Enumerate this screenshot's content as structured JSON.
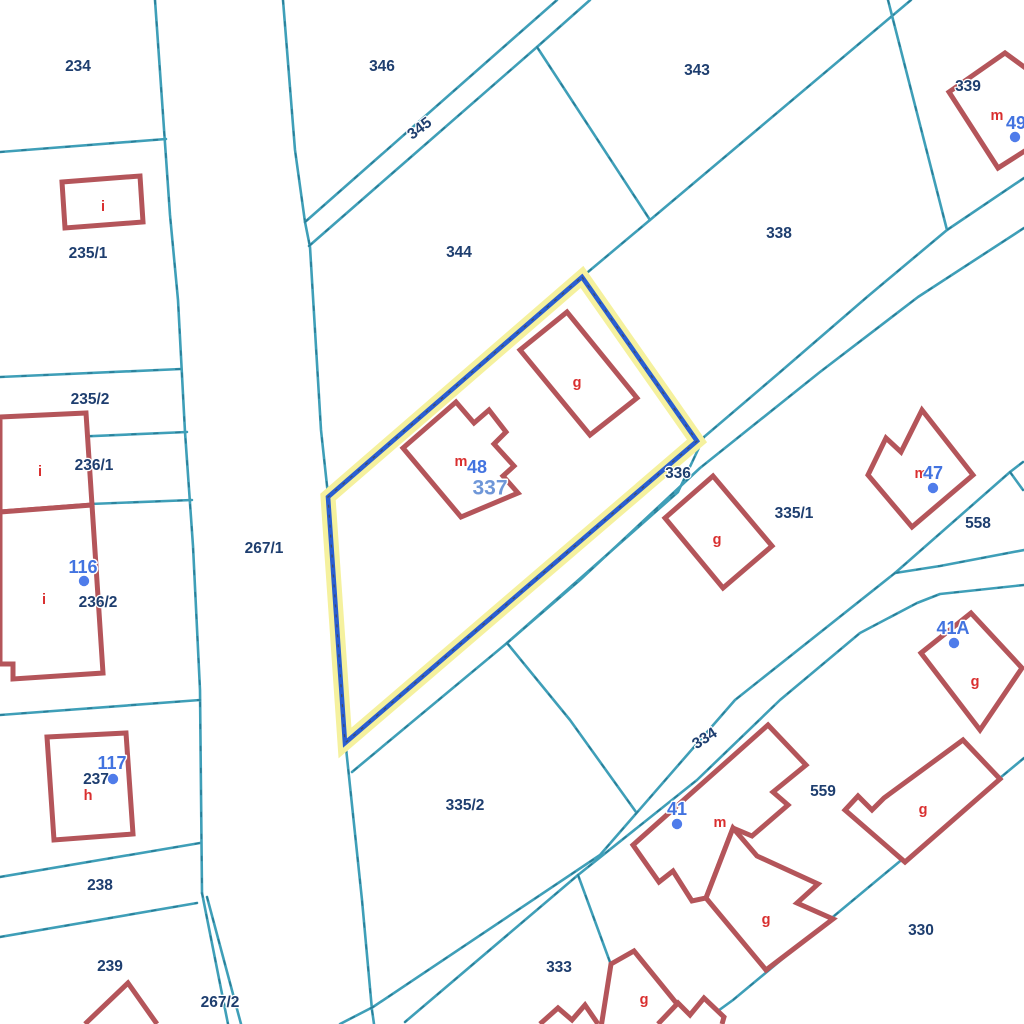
{
  "map": {
    "width": 1024,
    "height": 1024,
    "colors": {
      "background": "#ffffff",
      "parcel_line": "#3F9FB8",
      "parcel_line_dash": "#16607c",
      "building_line": "#B4555A",
      "building_fill": "#ffffff",
      "parcel_label": "#1E3E6F",
      "building_letter": "#D92F2F",
      "house_number": "#4273E0",
      "house_number_halo": "#ffffff",
      "highlight_band": "#F5F19E",
      "highlight_line": "#2A5ED1",
      "highlight_dash": "#444444",
      "selected_label": "#6F97D8",
      "dot": "#4F7CEA"
    },
    "highlight_parcel": {
      "id": "337",
      "points": [
        [
          582,
          277
        ],
        [
          697,
          441
        ],
        [
          345,
          743
        ],
        [
          328,
          497
        ]
      ]
    },
    "parcel_lines": [
      {
        "points": [
          [
            155,
            0
          ],
          [
            170,
            215
          ],
          [
            178,
            300
          ],
          [
            185,
            432
          ],
          [
            193,
            546
          ],
          [
            200,
            690
          ],
          [
            202,
            893
          ]
        ]
      },
      {
        "points": [
          [
            202,
            893
          ],
          [
            228,
            1024
          ]
        ]
      },
      {
        "points": [
          [
            207,
            897
          ],
          [
            241,
            1024
          ]
        ]
      },
      {
        "points": [
          [
            0,
            152
          ],
          [
            166,
            139
          ]
        ]
      },
      {
        "points": [
          [
            0,
            377
          ],
          [
            181,
            369
          ]
        ]
      },
      {
        "points": [
          [
            0,
            440
          ],
          [
            187,
            432
          ]
        ]
      },
      {
        "points": [
          [
            90,
            504
          ],
          [
            192,
            500
          ]
        ]
      },
      {
        "points": [
          [
            0,
            715
          ],
          [
            200,
            700
          ]
        ]
      },
      {
        "points": [
          [
            0,
            877
          ],
          [
            200,
            843
          ]
        ]
      },
      {
        "points": [
          [
            0,
            937
          ],
          [
            197,
            903
          ]
        ]
      },
      {
        "points": [
          [
            283,
            0
          ],
          [
            295,
            150
          ],
          [
            305,
            222
          ],
          [
            310,
            247
          ],
          [
            321,
            430
          ],
          [
            328,
            495
          ]
        ]
      },
      {
        "points": [
          [
            346,
            748
          ],
          [
            362,
            900
          ],
          [
            372,
            1010
          ],
          [
            374,
            1024
          ]
        ]
      },
      {
        "points": [
          [
            305,
            222
          ],
          [
            557,
            0
          ]
        ]
      },
      {
        "points": [
          [
            309,
            246
          ],
          [
            537,
            47
          ],
          [
            590,
            0
          ]
        ]
      },
      {
        "points": [
          [
            537,
            47
          ],
          [
            650,
            220
          ]
        ]
      },
      {
        "points": [
          [
            911,
            0
          ],
          [
            650,
            220
          ],
          [
            582,
            277
          ]
        ]
      },
      {
        "points": [
          [
            888,
            0
          ],
          [
            947,
            230
          ]
        ]
      },
      {
        "points": [
          [
            1024,
            178
          ],
          [
            947,
            230
          ],
          [
            867,
            297
          ],
          [
            779,
            373
          ],
          [
            704,
            437
          ]
        ]
      },
      {
        "points": [
          [
            704,
            437
          ],
          [
            678,
            492
          ],
          [
            507,
            643
          ],
          [
            352,
            772
          ]
        ]
      },
      {
        "points": [
          [
            1024,
            228
          ],
          [
            918,
            297
          ],
          [
            820,
            372
          ],
          [
            700,
            468
          ],
          [
            580,
            580
          ],
          [
            507,
            643
          ]
        ]
      },
      {
        "points": [
          [
            507,
            643
          ],
          [
            570,
            720
          ],
          [
            636,
            812
          ]
        ]
      },
      {
        "points": [
          [
            1023,
            462
          ],
          [
            1010,
            472
          ],
          [
            895,
            573
          ]
        ]
      },
      {
        "points": [
          [
            1010,
            472
          ],
          [
            1023,
            490
          ]
        ]
      },
      {
        "points": [
          [
            895,
            573
          ],
          [
            940,
            566
          ],
          [
            1024,
            550
          ]
        ]
      },
      {
        "points": [
          [
            1024,
            585
          ],
          [
            940,
            594
          ],
          [
            917,
            603
          ],
          [
            860,
            633
          ],
          [
            780,
            700
          ],
          [
            697,
            780
          ],
          [
            578,
            875
          ],
          [
            405,
            1022
          ]
        ]
      },
      {
        "points": [
          [
            895,
            573
          ],
          [
            735,
            700
          ],
          [
            600,
            855
          ],
          [
            373,
            1007
          ],
          [
            340,
            1024
          ]
        ]
      },
      {
        "points": [
          [
            578,
            875
          ],
          [
            632,
            1022
          ]
        ]
      },
      {
        "points": [
          [
            1024,
            758
          ],
          [
            733,
            1000
          ],
          [
            700,
            1024
          ]
        ]
      }
    ],
    "buildings": [
      {
        "closed": true,
        "points": [
          [
            62,
            182
          ],
          [
            140,
            176
          ],
          [
            143,
            222
          ],
          [
            65,
            228
          ]
        ]
      },
      {
        "closed": true,
        "points": [
          [
            0,
            417
          ],
          [
            86,
            413
          ],
          [
            92,
            505
          ],
          [
            0,
            512
          ]
        ]
      },
      {
        "closed": true,
        "points": [
          [
            0,
            512
          ],
          [
            92,
            505
          ],
          [
            103,
            673
          ],
          [
            13,
            679
          ],
          [
            13,
            664
          ],
          [
            0,
            664
          ]
        ]
      },
      {
        "closed": true,
        "points": [
          [
            47,
            737
          ],
          [
            126,
            733
          ],
          [
            133,
            834
          ],
          [
            54,
            840
          ]
        ]
      },
      {
        "closed": false,
        "points": [
          [
            85,
            1024
          ],
          [
            128,
            983
          ],
          [
            157,
            1024
          ]
        ]
      },
      {
        "closed": true,
        "points": [
          [
            403,
            448
          ],
          [
            456,
            402
          ],
          [
            474,
            423
          ],
          [
            489,
            410
          ],
          [
            506,
            432
          ],
          [
            494,
            444
          ],
          [
            514,
            466
          ],
          [
            503,
            476
          ],
          [
            518,
            493
          ],
          [
            461,
            517
          ]
        ]
      },
      {
        "closed": true,
        "points": [
          [
            520,
            350
          ],
          [
            567,
            312
          ],
          [
            637,
            398
          ],
          [
            590,
            435
          ]
        ]
      },
      {
        "closed": true,
        "points": [
          [
            665,
            518
          ],
          [
            713,
            476
          ],
          [
            772,
            546
          ],
          [
            723,
            588
          ]
        ]
      },
      {
        "closed": true,
        "points": [
          [
            922,
            410
          ],
          [
            973,
            475
          ],
          [
            912,
            527
          ],
          [
            868,
            475
          ],
          [
            886,
            438
          ],
          [
            901,
            452
          ]
        ]
      },
      {
        "closed": true,
        "points": [
          [
            949,
            92
          ],
          [
            1005,
            53
          ],
          [
            1042,
            80
          ],
          [
            1042,
            140
          ],
          [
            998,
            168
          ]
        ]
      },
      {
        "closed": true,
        "points": [
          [
            921,
            653
          ],
          [
            971,
            613
          ],
          [
            1022,
            668
          ],
          [
            980,
            730
          ]
        ]
      },
      {
        "closed": true,
        "points": [
          [
            633,
            845
          ],
          [
            768,
            725
          ],
          [
            806,
            765
          ],
          [
            773,
            792
          ],
          [
            788,
            805
          ],
          [
            752,
            836
          ],
          [
            733,
            828
          ],
          [
            706,
            898
          ],
          [
            692,
            901
          ],
          [
            673,
            871
          ],
          [
            659,
            882
          ]
        ]
      },
      {
        "closed": true,
        "points": [
          [
            733,
            828
          ],
          [
            757,
            856
          ],
          [
            818,
            884
          ],
          [
            797,
            903
          ],
          [
            833,
            919
          ],
          [
            766,
            970
          ],
          [
            706,
            898
          ]
        ]
      },
      {
        "closed": true,
        "points": [
          [
            963,
            740
          ],
          [
            1000,
            779
          ],
          [
            905,
            862
          ],
          [
            845,
            810
          ],
          [
            858,
            796
          ],
          [
            872,
            810
          ],
          [
            884,
            798
          ]
        ]
      },
      {
        "closed": true,
        "points": [
          [
            611,
            964
          ],
          [
            634,
            951
          ],
          [
            682,
            1010
          ],
          [
            648,
            1034
          ],
          [
            600,
            1034
          ]
        ]
      },
      {
        "closed": false,
        "points": [
          [
            658,
            1024
          ],
          [
            678,
            1003
          ],
          [
            690,
            1015
          ],
          [
            704,
            998
          ],
          [
            724,
            1017
          ],
          [
            722,
            1024
          ]
        ]
      },
      {
        "closed": false,
        "points": [
          [
            540,
            1024
          ],
          [
            558,
            1008
          ],
          [
            572,
            1020
          ],
          [
            585,
            1005
          ],
          [
            598,
            1024
          ]
        ]
      }
    ],
    "parcel_labels": [
      {
        "text": "234",
        "x": 78,
        "y": 67,
        "rotate": 0
      },
      {
        "text": "235/1",
        "x": 88,
        "y": 254,
        "rotate": 0
      },
      {
        "text": "235/2",
        "x": 90,
        "y": 400,
        "rotate": 0
      },
      {
        "text": "236/1",
        "x": 94,
        "y": 466,
        "rotate": 0
      },
      {
        "text": "236/2",
        "x": 98,
        "y": 603,
        "rotate": 0
      },
      {
        "text": "237",
        "x": 96,
        "y": 780,
        "rotate": 0
      },
      {
        "text": "238",
        "x": 100,
        "y": 886,
        "rotate": 0
      },
      {
        "text": "239",
        "x": 110,
        "y": 967,
        "rotate": 0
      },
      {
        "text": "267/1",
        "x": 264,
        "y": 549,
        "rotate": 0
      },
      {
        "text": "267/2",
        "x": 220,
        "y": 1003,
        "rotate": 0
      },
      {
        "text": "346",
        "x": 382,
        "y": 67,
        "rotate": 0
      },
      {
        "text": "345",
        "x": 420,
        "y": 129,
        "rotate": -37
      },
      {
        "text": "344",
        "x": 459,
        "y": 253,
        "rotate": 0
      },
      {
        "text": "343",
        "x": 697,
        "y": 71,
        "rotate": 0
      },
      {
        "text": "338",
        "x": 779,
        "y": 234,
        "rotate": 0
      },
      {
        "text": "339",
        "x": 968,
        "y": 87,
        "rotate": 0
      },
      {
        "text": "336",
        "x": 678,
        "y": 474,
        "rotate": 0
      },
      {
        "text": "335/1",
        "x": 794,
        "y": 514,
        "rotate": 0
      },
      {
        "text": "335/2",
        "x": 465,
        "y": 806,
        "rotate": 0
      },
      {
        "text": "334",
        "x": 705,
        "y": 739,
        "rotate": -33
      },
      {
        "text": "333",
        "x": 559,
        "y": 968,
        "rotate": 0
      },
      {
        "text": "330",
        "x": 921,
        "y": 931,
        "rotate": 0
      },
      {
        "text": "558",
        "x": 978,
        "y": 524,
        "rotate": 0
      },
      {
        "text": "559",
        "x": 823,
        "y": 792,
        "rotate": 0
      }
    ],
    "selected_parcel_label": {
      "text": "337",
      "x": 490,
      "y": 489
    },
    "building_letters": [
      {
        "text": "i",
        "x": 103,
        "y": 207
      },
      {
        "text": "i",
        "x": 40,
        "y": 472
      },
      {
        "text": "i",
        "x": 44,
        "y": 600
      },
      {
        "text": "h",
        "x": 88,
        "y": 796
      },
      {
        "text": "m",
        "x": 461,
        "y": 462
      },
      {
        "text": "g",
        "x": 577,
        "y": 383
      },
      {
        "text": "g",
        "x": 717,
        "y": 540
      },
      {
        "text": "m",
        "x": 921,
        "y": 474
      },
      {
        "text": "m",
        "x": 997,
        "y": 116
      },
      {
        "text": "g",
        "x": 975,
        "y": 682
      },
      {
        "text": "m",
        "x": 720,
        "y": 823
      },
      {
        "text": "g",
        "x": 766,
        "y": 920
      },
      {
        "text": "g",
        "x": 644,
        "y": 1000
      },
      {
        "text": "g",
        "x": 923,
        "y": 810
      }
    ],
    "house_numbers": [
      {
        "text": "48",
        "x": 477,
        "y": 468,
        "dot": null
      },
      {
        "text": "116",
        "x": 83,
        "y": 568,
        "dot": {
          "x": 84,
          "y": 581
        }
      },
      {
        "text": "117",
        "x": 112,
        "y": 764,
        "dot": {
          "x": 113,
          "y": 779
        }
      },
      {
        "text": "47",
        "x": 933,
        "y": 474,
        "dot": {
          "x": 933,
          "y": 488
        }
      },
      {
        "text": "49",
        "x": 1016,
        "y": 124,
        "dot": {
          "x": 1015,
          "y": 137
        }
      },
      {
        "text": "41A",
        "x": 953,
        "y": 629,
        "dot": {
          "x": 954,
          "y": 643
        }
      },
      {
        "text": "41",
        "x": 677,
        "y": 810,
        "dot": {
          "x": 677,
          "y": 824
        }
      }
    ]
  }
}
